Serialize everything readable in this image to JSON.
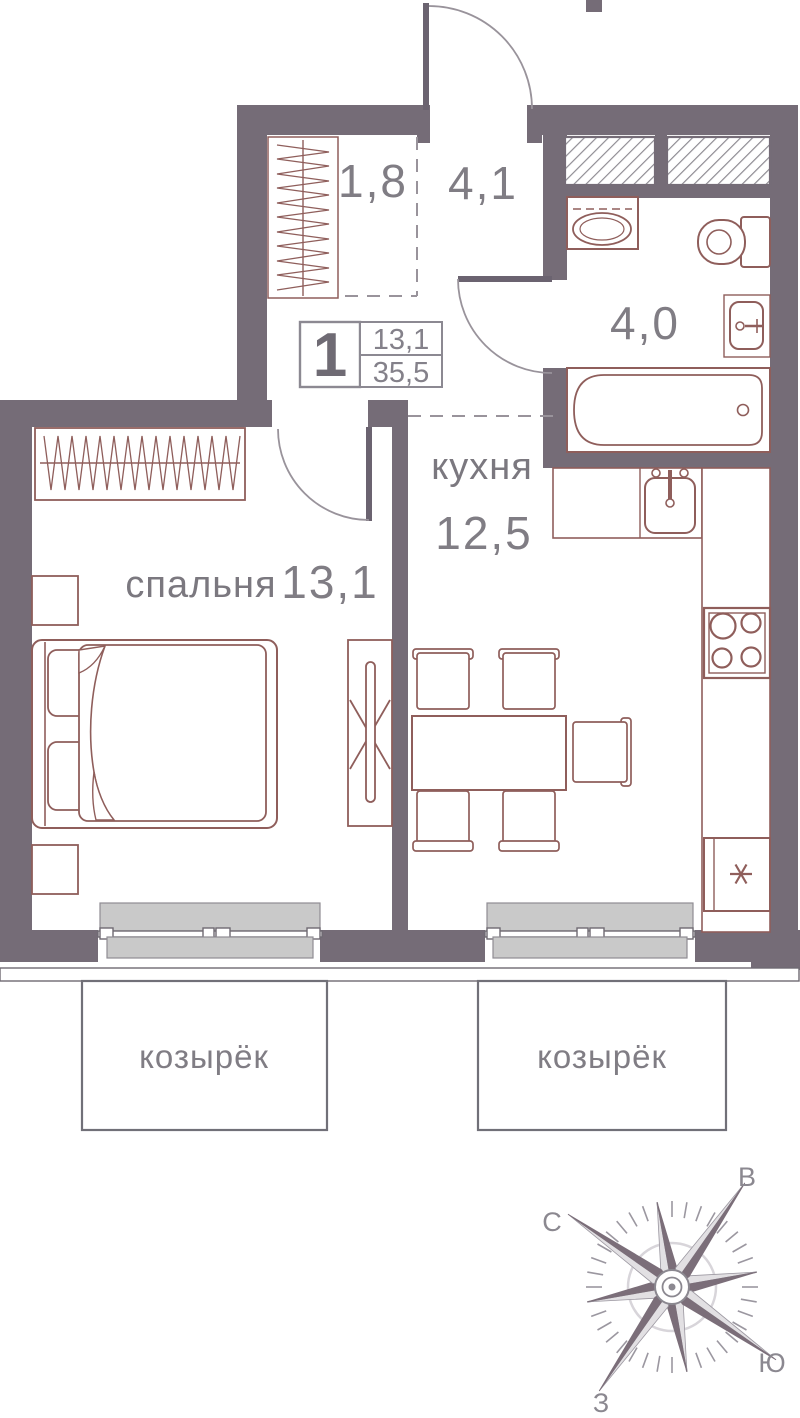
{
  "labels": {
    "closet_area": "1,8",
    "hall_area": "4,1",
    "bathroom_area": "4,0",
    "kitchen_name": "кухня",
    "kitchen_area": "12,5",
    "bedroom_name": "спальня",
    "bedroom_area": "13,1",
    "canopy_left": "козырёк",
    "canopy_right": "козырёк"
  },
  "info_box": {
    "rooms": "1",
    "living_area": "13,1",
    "total_area": "35,5"
  },
  "compass": {
    "north": "С",
    "east": "В",
    "south": "Ю",
    "west": "З"
  },
  "colors": {
    "wall": "#756c77",
    "furniture_outline": "#8f5e5b",
    "line_gray": "#99939b",
    "sill_gray": "#c9c9c9",
    "text_gray": "#807d84"
  }
}
